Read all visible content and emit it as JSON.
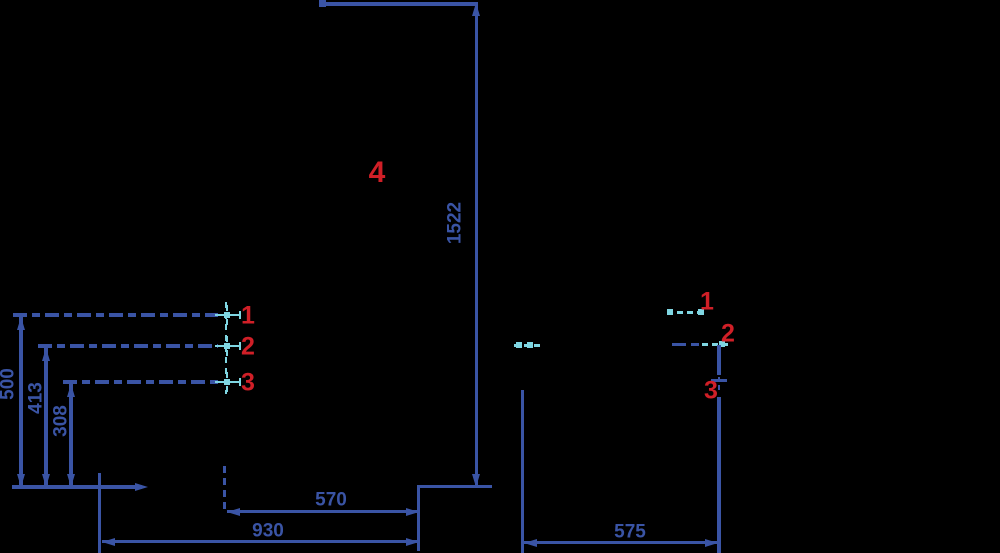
{
  "drawing": {
    "type": "technical-dimension-drawing",
    "background": "#000000",
    "colors": {
      "dimension_blue": "#3a54a5",
      "centerline_cyan": "#7fd6e2",
      "port_label_red": "#d01f27"
    },
    "front_view": {
      "overall_height": "1522",
      "width_inner": "570",
      "width_outer": "930",
      "port_heights": {
        "h1": "500",
        "h2": "413",
        "h3": "308"
      },
      "ports": {
        "p1": "1",
        "p2": "2",
        "p3": "3",
        "p4": "4"
      }
    },
    "side_view": {
      "depth": "575",
      "ports": {
        "p1": "1",
        "p2": "2",
        "p3": "3"
      }
    }
  }
}
